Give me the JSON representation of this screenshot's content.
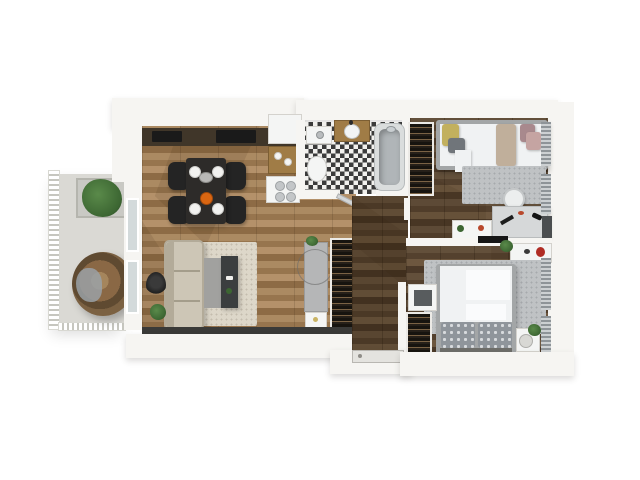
{
  "scene": {
    "type": "3d-floor-plan-render",
    "description": "Top-down 3D architectural render of a two-bedroom apartment with balcony, open living/dining/kitchen, bathroom, hallway and two bedrooms",
    "background": "#ffffff",
    "visible_text": ""
  },
  "colors": {
    "wall": "#f6f5f2",
    "wallEdge": "#dcd9d4",
    "floorBalcony": "#dad9d4",
    "railing": "#c6c6bf",
    "counterDark": "#403629",
    "cabinetWood": "#a07c46",
    "appliance": "#1a1a1a",
    "tableBlack": "#2d2b29",
    "chairBlack": "#242424",
    "plateWhite": "#f2f2f0",
    "dishOrange": "#d96612",
    "sofa": "#cdc6b6",
    "sofaEdge": "#b3ab99",
    "rugCream": "#ddd7c9",
    "tableGrey": "#a1a19f",
    "tableDarkTop": "#3b3e3f",
    "tile1": "#3b3b3b",
    "tile2": "#f1f0ed",
    "tub": "#b0b5b8",
    "tubRim": "#dadddd",
    "fixtureWhite": "#f4f5f4",
    "slatDark": "#17140f",
    "slatWood": "#7a6244",
    "trimWhite": "#eceae6",
    "bedFrame": "#a3a6a7",
    "duvet": "#f0f2f3",
    "pillowYellow": "#c2b05e",
    "pillowGrey": "#70757a",
    "pillowPink": "#c5a4a2",
    "pillowMauve": "#a8898d",
    "blanketTan": "#c0af9b",
    "rugGrey": "#bfc2c4",
    "desk": "#d6d8d9",
    "chairWhite": "#eceeee",
    "blindA": "#8e9498",
    "blindB": "#ccd0d2",
    "plantGreen": "#3c6632",
    "rattan": "#8a6845",
    "rattanDark": "#5f4a31",
    "tvBlack": "#161616",
    "screenGrey": "#585c5e",
    "doorGlass": "#d3dadb",
    "entryDoor": "#e4e3df"
  },
  "rooms": [
    {
      "name": "balcony",
      "furniture": [
        "railing",
        "planter-bush",
        "hanging-rattan-chair"
      ]
    },
    {
      "name": "living-dining-kitchen",
      "furniture": [
        "kitchen-counter",
        "hob",
        "sink",
        "fridge",
        "stove-unit",
        "dining-table",
        "four-black-chairs",
        "plates",
        "orange-dish",
        "sofa",
        "cream-rug",
        "two-tone-coffee-table",
        "floor-plants",
        "grey-cabinet",
        "slatted-wardrobe"
      ]
    },
    {
      "name": "bathroom",
      "furniture": [
        "checkered-tile-floor",
        "washer",
        "toilet",
        "wood-vanity-sink",
        "bathtub",
        "open-door"
      ]
    },
    {
      "name": "bedroom-top-right",
      "furniture": [
        "bed-with-colorful-pillows",
        "grey-rug",
        "desk",
        "round-chair",
        "white-dresser",
        "slatted-wardrobe",
        "window-blinds"
      ]
    },
    {
      "name": "hallway",
      "furniture": [
        "entry-door"
      ]
    },
    {
      "name": "bedroom-bottom-right",
      "furniture": [
        "double-bed",
        "patterned-pillows",
        "grey-rug",
        "wall-tv",
        "tv-cabinet",
        "white-shelf-plant",
        "nightstand-plant",
        "slatted-wardrobe",
        "window-blinds"
      ]
    }
  ]
}
